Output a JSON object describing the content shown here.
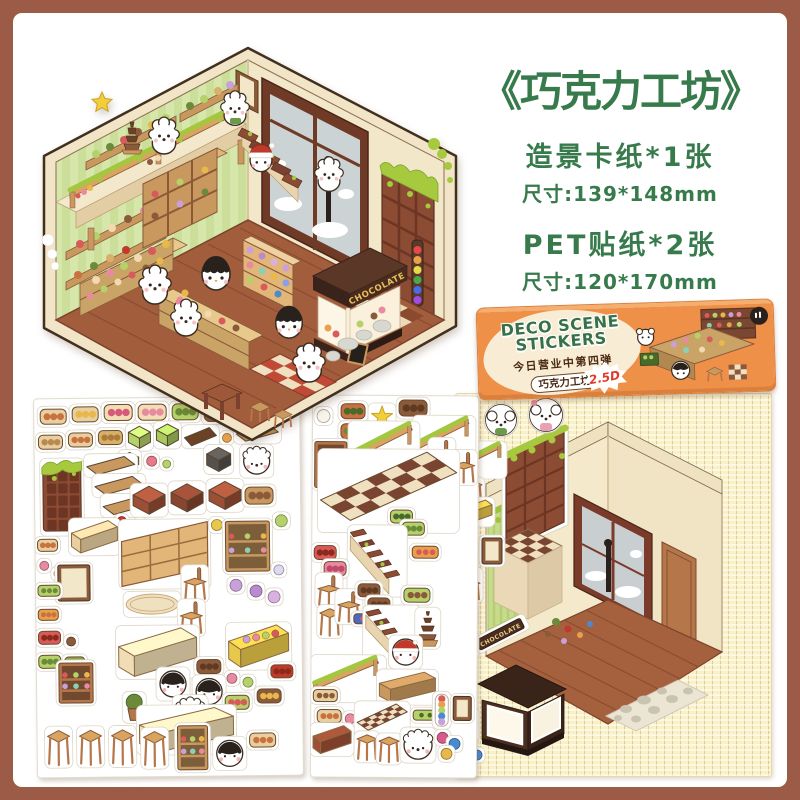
{
  "colors": {
    "frame": "#9b5b46",
    "green": "#377a4b",
    "orange": "#ef9049",
    "card": "#f9f0c8",
    "choco": "#7c4631"
  },
  "header": {
    "title": "《巧克力工坊》",
    "item1": "造景卡纸*1张",
    "item1_size": "尺寸:139*148mm",
    "item2": "PET贴纸*2张",
    "item2_size": "尺寸:120*170mm"
  },
  "package": {
    "brand_line1": "DECO SCENE",
    "brand_line2": "STICKERS",
    "tagline": "今日营业中第四弹",
    "series_pill": "巧克力工坊",
    "badge": "2.5D"
  },
  "scene": {
    "sign": "CHOCOLATE"
  },
  "card": {
    "sign": "CHOCOLATE"
  },
  "stickers": {
    "left": [
      [
        "tray",
        6,
        10,
        26,
        15,
        "#e8cfa0",
        "#c9713f"
      ],
      [
        "tray",
        38,
        8,
        26,
        15,
        "#e8cfa0",
        "#e8b84a"
      ],
      [
        "tray",
        70,
        6,
        28,
        16,
        "#f3ddb5",
        "#d85a7a"
      ],
      [
        "tray",
        104,
        6,
        28,
        16,
        "#f3ddb5",
        "#e88aa0"
      ],
      [
        "tray",
        138,
        6,
        26,
        16,
        "#b5d16a",
        "#6b8a3a"
      ],
      [
        "tray",
        170,
        6,
        30,
        18,
        "#8a5a3a",
        "#5f3a22"
      ],
      [
        "tray",
        206,
        8,
        26,
        16,
        "#f3e3c8",
        "#8a5a3a"
      ],
      [
        "tray",
        4,
        36,
        24,
        14,
        "#e8cfa0",
        "#b98a50"
      ],
      [
        "tray",
        34,
        34,
        24,
        14,
        "#e8cfa0",
        "#c9713f"
      ],
      [
        "tray",
        64,
        32,
        24,
        14,
        "#d9b06a",
        "#a97c3a"
      ],
      [
        "cube",
        94,
        28,
        22,
        22,
        "#b5d16a"
      ],
      [
        "cube",
        122,
        26,
        22,
        22,
        "#a8c95e"
      ],
      [
        "slab",
        150,
        30,
        32,
        18,
        "#6b4226"
      ],
      [
        "dot",
        188,
        36,
        9,
        9,
        "#e8a04a"
      ],
      [
        "slab",
        202,
        28,
        42,
        16,
        "#c9985f"
      ],
      [
        "cube",
        86,
        54,
        18,
        17,
        "#8a8a84"
      ],
      [
        "dot",
        112,
        58,
        10,
        10,
        "#e87a8a"
      ],
      [
        "dot",
        128,
        62,
        8,
        8,
        "#b5d16a"
      ],
      [
        "cube",
        172,
        50,
        24,
        24,
        "#55524e"
      ],
      [
        "face",
        208,
        50,
        28,
        28,
        "dog"
      ],
      [
        "door",
        8,
        62,
        38,
        72
      ],
      [
        "slab",
        52,
        58,
        48,
        18,
        "#c9985f"
      ],
      [
        "slab",
        60,
        78,
        48,
        18,
        "#c9985f"
      ],
      [
        "slab",
        68,
        98,
        48,
        18,
        "#c9985f"
      ],
      [
        "cube",
        98,
        88,
        32,
        28,
        "#9c4f35"
      ],
      [
        "cube",
        136,
        86,
        32,
        28,
        "#8a4530"
      ],
      [
        "cube",
        174,
        84,
        32,
        28,
        "#9c4f35"
      ],
      [
        "tray",
        210,
        90,
        28,
        17,
        "#c9985f",
        "#8a5a3a"
      ],
      [
        "dot",
        82,
        118,
        9,
        9,
        "#c0392b"
      ],
      [
        "dot",
        100,
        122,
        9,
        9,
        "#8a5a3a"
      ],
      [
        "dot",
        118,
        124,
        9,
        9,
        "#b5d16a"
      ],
      [
        "bench",
        36,
        122,
        46,
        32,
        "#e8cfa0"
      ],
      [
        "shelfgrid",
        86,
        124,
        86,
        64,
        "#e2b578"
      ],
      [
        "dot",
        176,
        122,
        11,
        11,
        "#e8c84a"
      ],
      [
        "wallshelf",
        190,
        124,
        44,
        50,
        "#c9985f"
      ],
      [
        "dot",
        240,
        118,
        12,
        12,
        "#b5d16a"
      ],
      [
        "tray",
        2,
        140,
        20,
        12,
        "#e8cfa0",
        "#c9713f"
      ],
      [
        "dot",
        4,
        162,
        9,
        9,
        "#e88aa0"
      ],
      [
        "dot",
        18,
        170,
        9,
        9,
        "#f3ddb5"
      ],
      [
        "frame",
        22,
        166,
        32,
        36,
        "#8a5a3a"
      ],
      [
        "tray",
        2,
        186,
        22,
        11,
        "#b5d16a",
        "#6b8a3a"
      ],
      [
        "tray",
        2,
        210,
        20,
        11,
        "#e8a04a",
        "#c9713f"
      ],
      [
        "rug",
        90,
        196,
        52,
        20
      ],
      [
        "chair",
        148,
        170,
        22,
        32
      ],
      [
        "chair",
        144,
        204,
        22,
        32
      ],
      [
        "dot",
        194,
        182,
        12,
        12,
        "#c9a0d9"
      ],
      [
        "dot",
        214,
        188,
        12,
        12,
        "#b98ad0"
      ],
      [
        "dot",
        232,
        194,
        12,
        12,
        "#d9b0e0"
      ],
      [
        "dot",
        238,
        168,
        10,
        10,
        "#e0d8f0"
      ],
      [
        "tray",
        2,
        232,
        22,
        13,
        "#d85a5a",
        "#8a2a1a"
      ],
      [
        "dot",
        30,
        238,
        9,
        9,
        "#8a5a3a"
      ],
      [
        "tray",
        2,
        256,
        22,
        13,
        "#b5d16a",
        "#6b8a3a"
      ],
      [
        "tray",
        28,
        258,
        20,
        12,
        "#8aa94a",
        "#4a6a2a"
      ],
      [
        "bench",
        82,
        230,
        78,
        48,
        "#f0ddb5"
      ],
      [
        "counter",
        192,
        228,
        60,
        42,
        "#e8c84a"
      ],
      [
        "tray",
        160,
        262,
        24,
        14,
        "#8a5a3a",
        "#5f3a22"
      ],
      [
        "dot",
        190,
        276,
        10,
        10,
        "#e88aa0"
      ],
      [
        "dot",
        206,
        280,
        10,
        10,
        "#b5d16a"
      ],
      [
        "face",
        122,
        272,
        28,
        28,
        "peng"
      ],
      [
        "face",
        158,
        280,
        28,
        28,
        "peng"
      ],
      [
        "wallshelf",
        22,
        264,
        34,
        40,
        "#b5764a"
      ],
      [
        "plant",
        88,
        296,
        18,
        26
      ],
      [
        "face",
        138,
        300,
        30,
        30,
        "dog"
      ],
      [
        "tray",
        188,
        298,
        24,
        14,
        "#b5d16a",
        "#d85a5a"
      ],
      [
        "tray",
        220,
        292,
        24,
        14,
        "#8a5a3a",
        "#e8b84a"
      ],
      [
        "tray",
        234,
        268,
        22,
        13,
        "#c0392b",
        "#8a2a1a"
      ],
      [
        "bench",
        102,
        310,
        94,
        44,
        "#f0ddb5"
      ],
      [
        "stool",
        10,
        330,
        22,
        36
      ],
      [
        "stool",
        42,
        330,
        22,
        36
      ],
      [
        "stool",
        74,
        330,
        22,
        36
      ],
      [
        "stool",
        106,
        332,
        22,
        36
      ],
      [
        "wallshelf",
        140,
        328,
        30,
        44,
        "#c9985f"
      ],
      [
        "face",
        178,
        342,
        28,
        28,
        "peng"
      ],
      [
        "tray",
        212,
        336,
        26,
        14,
        "#e8cfa0",
        "#c9713f"
      ]
    ],
    "middle": [
      [
        "dot",
        4,
        14,
        13,
        13,
        "#f8f4ec"
      ],
      [
        "tray",
        28,
        8,
        24,
        15,
        "#c9713f",
        "#4a6a2a"
      ],
      [
        "tray",
        28,
        28,
        24,
        15,
        "#c9713f",
        "#6b8a3a"
      ],
      [
        "star",
        58,
        10,
        22,
        22
      ],
      [
        "tray",
        86,
        4,
        28,
        16,
        "#8a5a3a",
        "#5f3a22"
      ],
      [
        "railing",
        102,
        22,
        58,
        42
      ],
      [
        "wallshelf",
        2,
        46,
        32,
        46,
        "#b5764a"
      ],
      [
        "railing",
        38,
        28,
        66,
        48
      ],
      [
        "chair",
        118,
        44,
        22,
        30
      ],
      [
        "chair",
        140,
        56,
        22,
        30
      ],
      [
        "checker",
        8,
        56,
        136,
        78
      ],
      [
        "tray",
        78,
        114,
        22,
        13,
        "#b5d16a",
        "#4a6a2a"
      ],
      [
        "tray",
        90,
        126,
        22,
        13,
        "#b5d16a",
        "#6b8a3a"
      ],
      [
        "stairs",
        38,
        132,
        54,
        66
      ],
      [
        "tray",
        100,
        150,
        26,
        12,
        "#e8a04a",
        "#d85a5a"
      ],
      [
        "tray",
        2,
        150,
        22,
        14,
        "#d85a5a",
        "#8a2a1a"
      ],
      [
        "tray",
        12,
        166,
        22,
        14,
        "#e88aa0",
        "#c04a6a"
      ],
      [
        "chair",
        6,
        180,
        22,
        30
      ],
      [
        "stool",
        8,
        212,
        20,
        28
      ],
      [
        "chair",
        26,
        196,
        22,
        30
      ],
      [
        "tray",
        46,
        188,
        22,
        13,
        "#8a5a3a",
        "#5f3a22"
      ],
      [
        "tray",
        56,
        202,
        22,
        13,
        "#8a5a3a",
        "#5f3a22"
      ],
      [
        "tray",
        42,
        218,
        32,
        10,
        "#4a6ac0",
        "#d85a5a"
      ],
      [
        "tray",
        92,
        192,
        26,
        14,
        "#b5d16a",
        "#8a5a3a"
      ],
      [
        "stairs",
        54,
        212,
        52,
        60
      ],
      [
        "tower",
        106,
        214,
        20,
        36
      ],
      [
        "face",
        80,
        242,
        28,
        28,
        "santa"
      ],
      [
        "railing",
        2,
        262,
        70,
        42
      ],
      [
        "bench",
        68,
        276,
        56,
        30,
        "#c9985f"
      ],
      [
        "tray",
        2,
        294,
        24,
        12,
        "#e8cfa0",
        "#8a5a3a"
      ],
      [
        "tray",
        6,
        314,
        24,
        13,
        "#e8cfa0",
        "#c9713f"
      ],
      [
        "dot",
        34,
        318,
        10,
        10,
        "#e88aa0"
      ],
      [
        "checker",
        46,
        308,
        50,
        30
      ],
      [
        "tray",
        102,
        314,
        32,
        10,
        "#b5d16a",
        "#4a6a2a"
      ],
      [
        "candy",
        124,
        298,
        13,
        32
      ],
      [
        "frame",
        142,
        300,
        18,
        24,
        "#8a5a3a"
      ],
      [
        "bench",
        2,
        330,
        38,
        28,
        "#9c4f35"
      ],
      [
        "stool",
        46,
        338,
        20,
        26
      ],
      [
        "stool",
        68,
        340,
        20,
        26
      ],
      [
        "face",
        92,
        334,
        30,
        30,
        "dog"
      ],
      [
        "dot",
        126,
        336,
        11,
        11,
        "#d85a8a"
      ],
      [
        "dot",
        138,
        342,
        11,
        11,
        "#4a8ad0"
      ],
      [
        "dot",
        130,
        352,
        11,
        11,
        "#e8b84a"
      ]
    ],
    "card_margin": [
      [
        "railing",
        2,
        50,
        46,
        32
      ],
      [
        "stool",
        8,
        86,
        18,
        24
      ],
      [
        "bench",
        4,
        106,
        32,
        24,
        "#e8c84a"
      ],
      [
        "frame",
        26,
        144,
        20,
        26,
        "#8a5a3a"
      ],
      [
        "chair",
        4,
        176,
        20,
        30
      ],
      [
        "plant",
        3,
        210,
        16,
        22
      ],
      [
        "frame",
        2,
        240,
        18,
        24,
        "#3a2c20"
      ],
      [
        "candy",
        8,
        316,
        12,
        30
      ],
      [
        "dot",
        3,
        352,
        10,
        10,
        "#d85a8a"
      ],
      [
        "dot",
        16,
        356,
        10,
        10,
        "#4a8ad0"
      ]
    ]
  }
}
